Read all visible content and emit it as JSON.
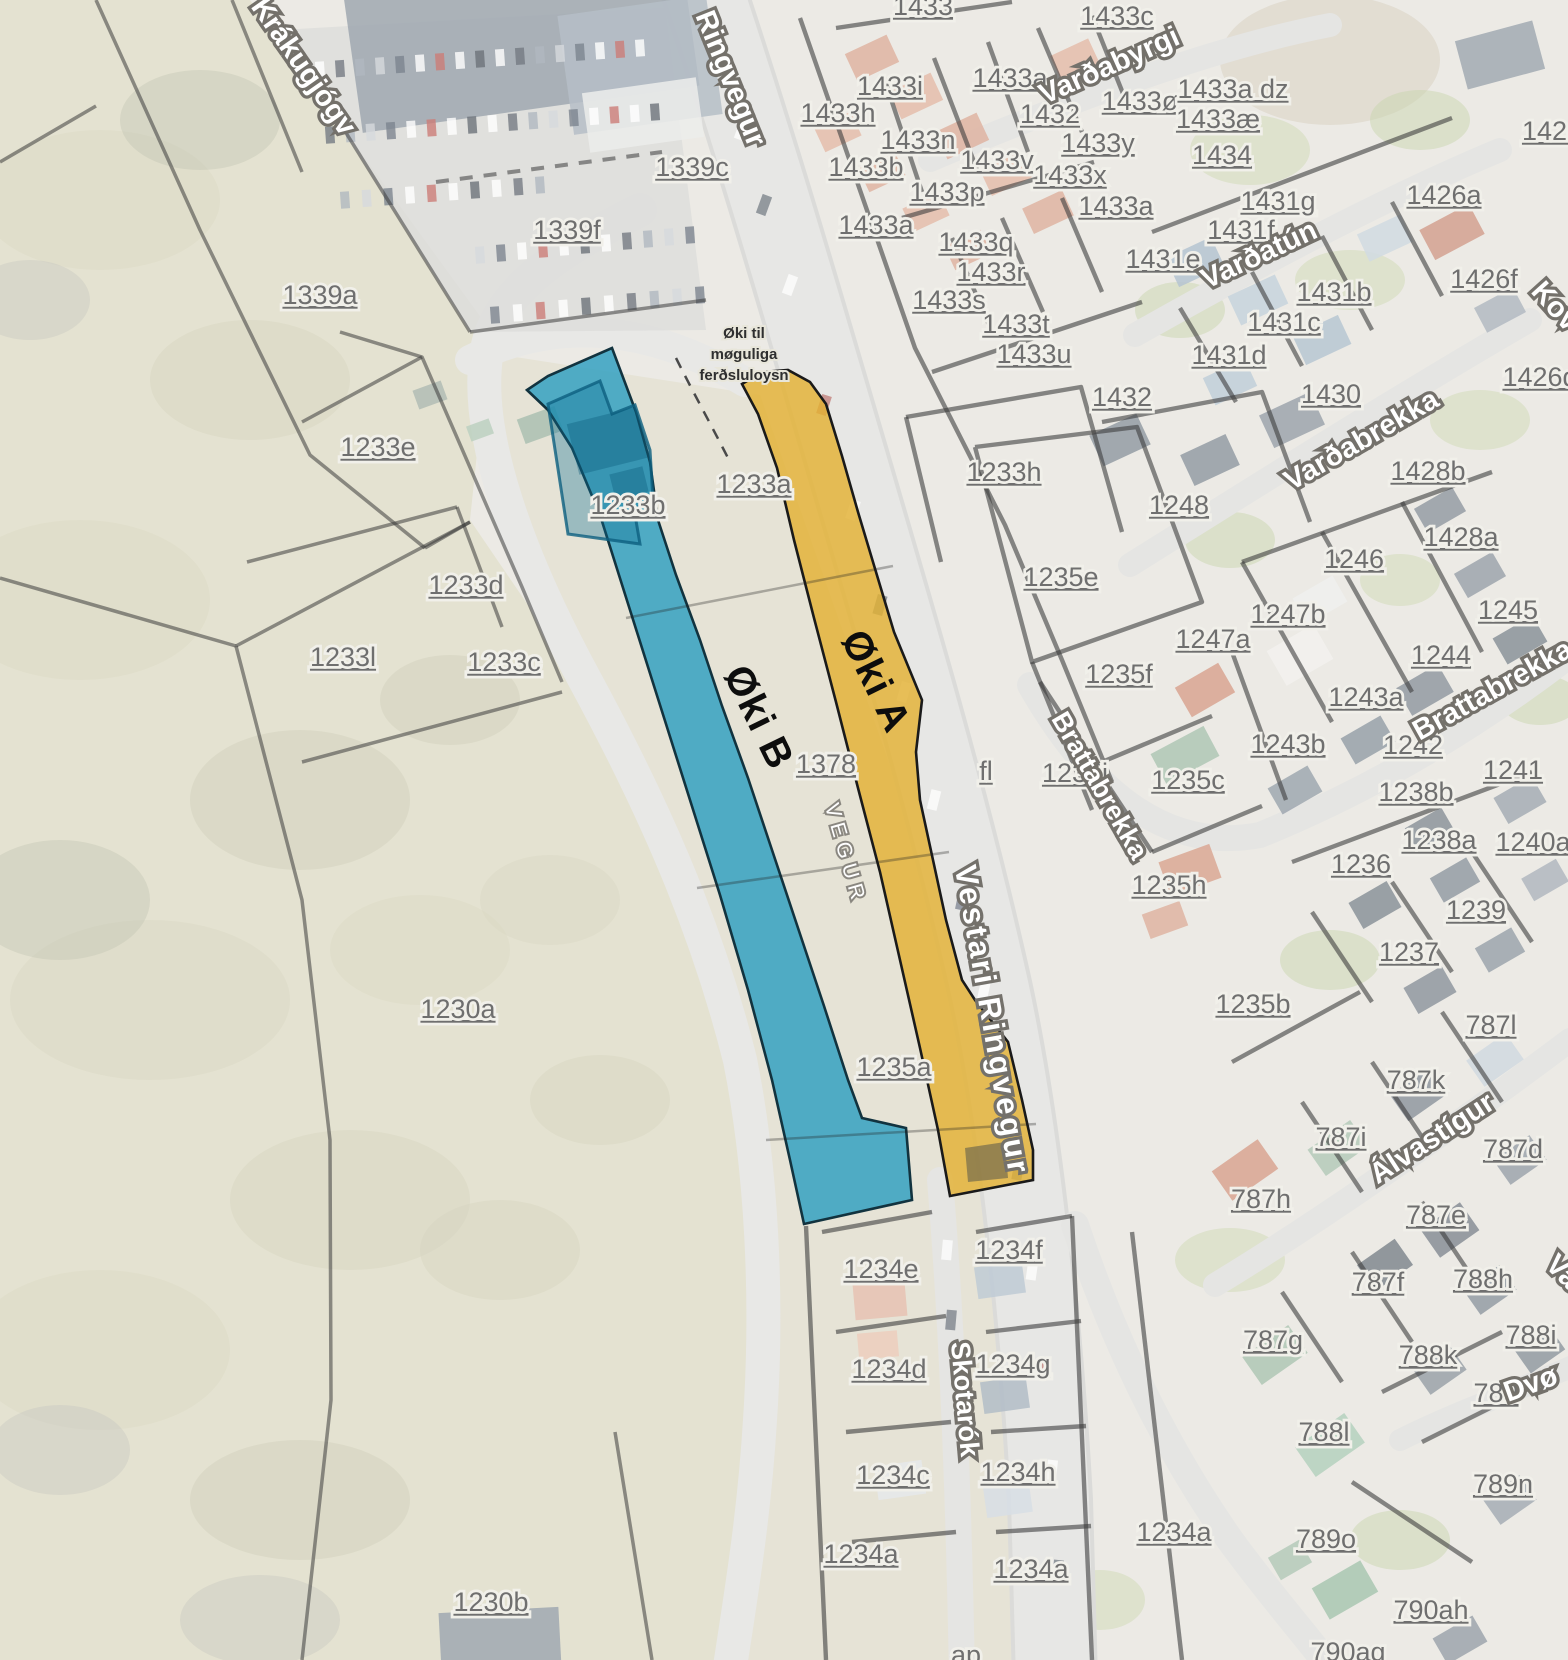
{
  "map": {
    "background_color": "#e9e7e0",
    "zones": [
      {
        "id": "A",
        "fill": "#e3b133",
        "outline": "#1a1a1a",
        "label": {
          "text": "Øki A",
          "x": 864,
          "y": 687,
          "rotation": 64,
          "size": 40
        }
      },
      {
        "id": "B",
        "fill": "#2d9fc0",
        "outline": "#12333f",
        "label": {
          "text": "Øki B",
          "x": 747,
          "y": 723,
          "rotation": 64,
          "size": 40
        }
      }
    ],
    "annotation": {
      "lines": [
        "Øki til",
        "møguliga",
        "ferðsluloysn"
      ],
      "x": 744,
      "y": 338,
      "line_height": 21
    },
    "street_labels": [
      {
        "text": "Krákugjógv",
        "x": 296,
        "y": 62,
        "rotation": 55,
        "size": 29
      },
      {
        "text": "Ringvegur",
        "x": 722,
        "y": 72,
        "rotation": 68,
        "size": 29
      },
      {
        "text": "Varðabyrgi",
        "x": 1113,
        "y": 64,
        "rotation": -24,
        "size": 29
      },
      {
        "text": "Varðatún",
        "x": 1263,
        "y": 253,
        "rotation": -25,
        "size": 29
      },
      {
        "text": "Varðabrekka",
        "x": 1366,
        "y": 438,
        "rotation": -30,
        "size": 29
      },
      {
        "text": "Kov",
        "x": 1530,
        "y": 282,
        "rotation": 48,
        "size": 29,
        "anchor": "start"
      },
      {
        "text": "Brattabrekka",
        "x": 1092,
        "y": 780,
        "rotation": 60,
        "size": 27
      },
      {
        "text": "Brattabrekka",
        "x": 1497,
        "y": 688,
        "rotation": -29,
        "size": 29
      },
      {
        "text": "Vestari Ringvegur",
        "x": 982,
        "y": 1012,
        "rotation": 80,
        "size": 31,
        "letter_spacing": 3
      },
      {
        "text": "Skotarók",
        "x": 956,
        "y": 1390,
        "rotation": 85,
        "size": 27
      },
      {
        "text": "Álvastígur",
        "x": 1437,
        "y": 1136,
        "rotation": -33,
        "size": 29
      },
      {
        "text": "Dvø",
        "x": 1508,
        "y": 1392,
        "rotation": -20,
        "size": 29,
        "anchor": "start"
      },
      {
        "text": "Va",
        "x": 1544,
        "y": 1256,
        "rotation": 45,
        "size": 29,
        "anchor": "start"
      },
      {
        "text": "VEGUR",
        "x": 839,
        "y": 846,
        "rotation": 74,
        "size": 21,
        "letter_spacing": 6,
        "variant": "minor"
      }
    ],
    "parcel_labels": [
      {
        "text": "1433",
        "x": 923,
        "y": 6
      },
      {
        "text": "1433c",
        "x": 1117,
        "y": 16
      },
      {
        "text": "1433i",
        "x": 890,
        "y": 86
      },
      {
        "text": "1433h",
        "x": 838,
        "y": 113
      },
      {
        "text": "1433a",
        "x": 1010,
        "y": 78
      },
      {
        "text": "1432",
        "x": 1050,
        "y": 114
      },
      {
        "text": "1433ø",
        "x": 1140,
        "y": 101
      },
      {
        "text": "1433y",
        "x": 1098,
        "y": 143
      },
      {
        "text": "1433n",
        "x": 918,
        "y": 140
      },
      {
        "text": "1433v",
        "x": 997,
        "y": 160
      },
      {
        "text": "1433x",
        "x": 1070,
        "y": 175
      },
      {
        "text": "1433b",
        "x": 866,
        "y": 167
      },
      {
        "text": "1433æ",
        "x": 1218,
        "y": 119
      },
      {
        "text": "1433a dz",
        "x": 1233,
        "y": 89
      },
      {
        "text": "1434",
        "x": 1222,
        "y": 155
      },
      {
        "text": "1433p",
        "x": 947,
        "y": 192
      },
      {
        "text": "1433a",
        "x": 876,
        "y": 225
      },
      {
        "text": "1433a",
        "x": 1116,
        "y": 206
      },
      {
        "text": "1433q",
        "x": 976,
        "y": 242
      },
      {
        "text": "1433r",
        "x": 991,
        "y": 272
      },
      {
        "text": "1433s",
        "x": 949,
        "y": 300
      },
      {
        "text": "1433t",
        "x": 1016,
        "y": 324
      },
      {
        "text": "1433u",
        "x": 1034,
        "y": 354
      },
      {
        "text": "1431g",
        "x": 1278,
        "y": 201
      },
      {
        "text": "1431f",
        "x": 1241,
        "y": 230
      },
      {
        "text": "1431e",
        "x": 1163,
        "y": 259
      },
      {
        "text": "1426",
        "x": 1552,
        "y": 131
      },
      {
        "text": "1426a",
        "x": 1444,
        "y": 195
      },
      {
        "text": "1426f",
        "x": 1484,
        "y": 279
      },
      {
        "text": "1426d",
        "x": 1540,
        "y": 377
      },
      {
        "text": "1431b",
        "x": 1334,
        "y": 292
      },
      {
        "text": "1431c",
        "x": 1284,
        "y": 322
      },
      {
        "text": "1431d",
        "x": 1229,
        "y": 355
      },
      {
        "text": "1432",
        "x": 1122,
        "y": 397
      },
      {
        "text": "1430",
        "x": 1331,
        "y": 394
      },
      {
        "text": "1428b",
        "x": 1428,
        "y": 471
      },
      {
        "text": "1428a",
        "x": 1461,
        "y": 537
      },
      {
        "text": "1246",
        "x": 1354,
        "y": 559
      },
      {
        "text": "1248",
        "x": 1179,
        "y": 505
      },
      {
        "text": "1339c",
        "x": 692,
        "y": 167
      },
      {
        "text": "1339f",
        "x": 567,
        "y": 230
      },
      {
        "text": "1339a",
        "x": 320,
        "y": 295
      },
      {
        "text": "1233e",
        "x": 378,
        "y": 447
      },
      {
        "text": "1233d",
        "x": 466,
        "y": 585
      },
      {
        "text": "1233l",
        "x": 343,
        "y": 657
      },
      {
        "text": "1233c",
        "x": 504,
        "y": 662
      },
      {
        "text": "1233b",
        "x": 628,
        "y": 505
      },
      {
        "text": "1233a",
        "x": 754,
        "y": 484
      },
      {
        "text": "1233h",
        "x": 1004,
        "y": 472
      },
      {
        "text": "1235e",
        "x": 1061,
        "y": 577
      },
      {
        "text": "1247b",
        "x": 1288,
        "y": 614
      },
      {
        "text": "1247a",
        "x": 1213,
        "y": 639
      },
      {
        "text": "1245",
        "x": 1508,
        "y": 610
      },
      {
        "text": "1244",
        "x": 1441,
        "y": 655
      },
      {
        "text": "1243a",
        "x": 1366,
        "y": 697
      },
      {
        "text": "1235f",
        "x": 1119,
        "y": 674
      },
      {
        "text": "1243b",
        "x": 1288,
        "y": 744
      },
      {
        "text": "1242",
        "x": 1413,
        "y": 745
      },
      {
        "text": "1235i",
        "x": 1075,
        "y": 773
      },
      {
        "text": "1235c",
        "x": 1188,
        "y": 780
      },
      {
        "text": "1241",
        "x": 1513,
        "y": 770
      },
      {
        "text": "1238b",
        "x": 1416,
        "y": 792
      },
      {
        "text": "1238a",
        "x": 1439,
        "y": 840
      },
      {
        "text": "1240a",
        "x": 1533,
        "y": 842
      },
      {
        "text": "1236",
        "x": 1361,
        "y": 864
      },
      {
        "text": "1239",
        "x": 1476,
        "y": 910
      },
      {
        "text": "1237",
        "x": 1409,
        "y": 952
      },
      {
        "text": "1235h",
        "x": 1169,
        "y": 885
      },
      {
        "text": "1378",
        "x": 826,
        "y": 764
      },
      {
        "text": "fl",
        "x": 986,
        "y": 771
      },
      {
        "text": "1230a",
        "x": 458,
        "y": 1009
      },
      {
        "text": "1235a",
        "x": 894,
        "y": 1067
      },
      {
        "text": "1235b",
        "x": 1253,
        "y": 1004
      },
      {
        "text": "787l",
        "x": 1491,
        "y": 1025
      },
      {
        "text": "787k",
        "x": 1416,
        "y": 1080
      },
      {
        "text": "787i",
        "x": 1341,
        "y": 1137
      },
      {
        "text": "787d",
        "x": 1513,
        "y": 1149
      },
      {
        "text": "787h",
        "x": 1261,
        "y": 1199
      },
      {
        "text": "787e",
        "x": 1436,
        "y": 1215
      },
      {
        "text": "787f",
        "x": 1378,
        "y": 1282
      },
      {
        "text": "788h",
        "x": 1483,
        "y": 1279
      },
      {
        "text": "787g",
        "x": 1273,
        "y": 1340
      },
      {
        "text": "788k",
        "x": 1428,
        "y": 1355
      },
      {
        "text": "788i",
        "x": 1531,
        "y": 1335
      },
      {
        "text": "789",
        "x": 1496,
        "y": 1393
      },
      {
        "text": "788l",
        "x": 1324,
        "y": 1432
      },
      {
        "text": "789n",
        "x": 1503,
        "y": 1484
      },
      {
        "text": "789o",
        "x": 1326,
        "y": 1539
      },
      {
        "text": "1234a",
        "x": 1174,
        "y": 1532
      },
      {
        "text": "790ah",
        "x": 1431,
        "y": 1610
      },
      {
        "text": "790ag",
        "x": 1348,
        "y": 1652
      },
      {
        "text": "1234e",
        "x": 881,
        "y": 1269
      },
      {
        "text": "1234f",
        "x": 1009,
        "y": 1250
      },
      {
        "text": "1234d",
        "x": 889,
        "y": 1369
      },
      {
        "text": "1234g",
        "x": 1013,
        "y": 1364
      },
      {
        "text": "1234c",
        "x": 893,
        "y": 1475
      },
      {
        "text": "1234h",
        "x": 1018,
        "y": 1472
      },
      {
        "text": "1234a",
        "x": 861,
        "y": 1554
      },
      {
        "text": "1234a",
        "x": 1031,
        "y": 1569
      },
      {
        "text": "1230b",
        "x": 491,
        "y": 1602
      },
      {
        "text": "ap",
        "x": 966,
        "y": 1655
      }
    ]
  }
}
